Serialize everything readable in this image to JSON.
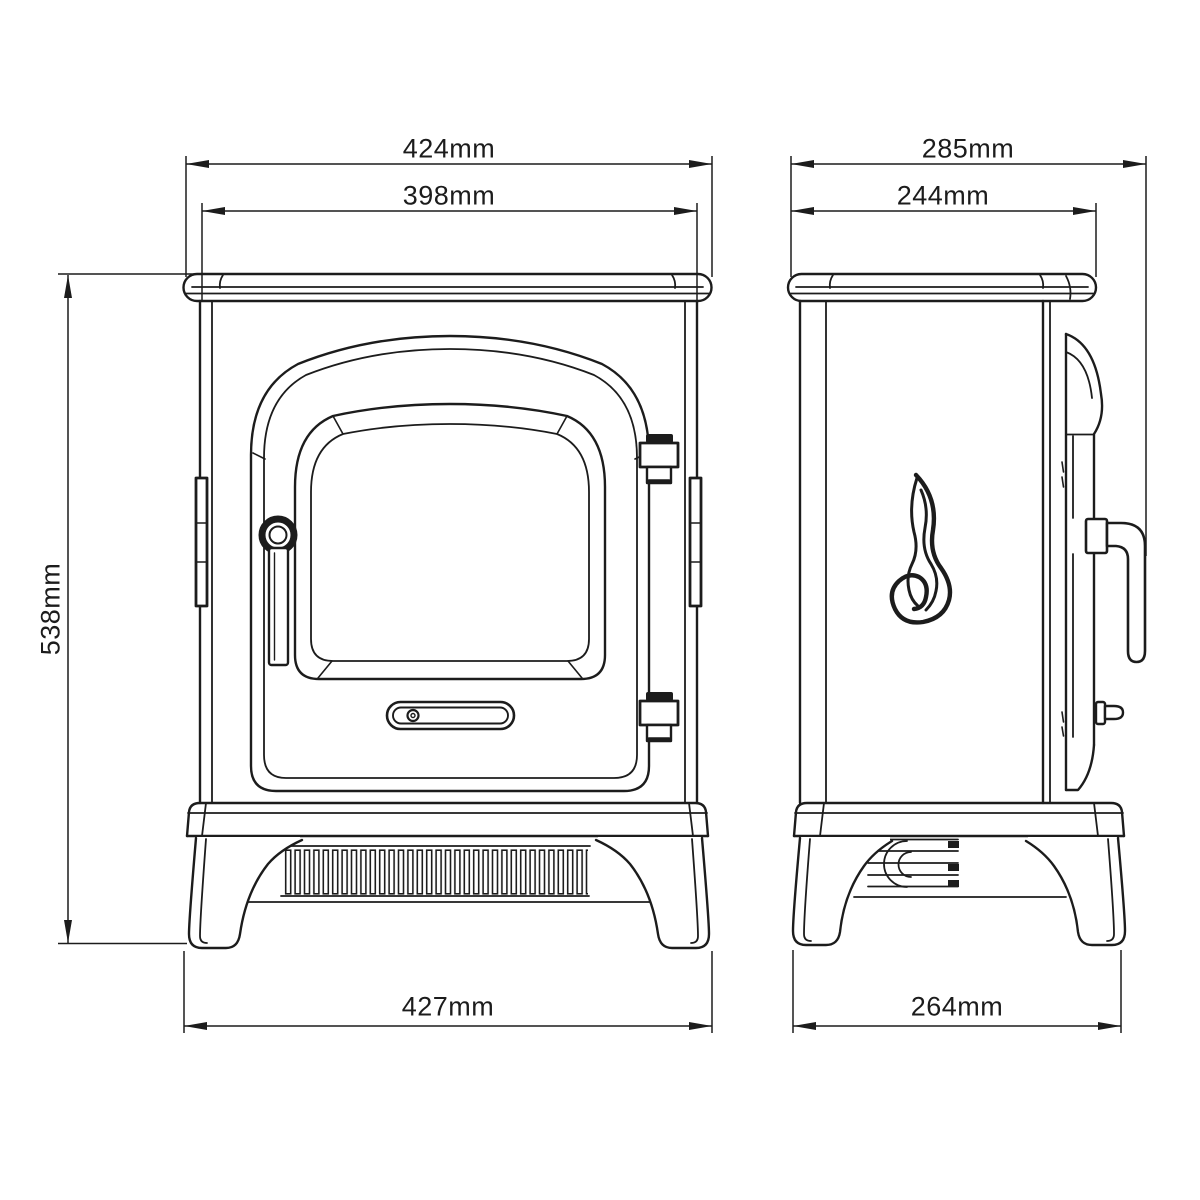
{
  "drawing": {
    "background": "#ffffff",
    "line_color": "#1c1c1c",
    "unit": "mm",
    "front_view": {
      "dim_overall_width": "424mm",
      "dim_body_width": "398mm",
      "dim_overall_height": "538mm",
      "dim_base_width": "427mm"
    },
    "side_view": {
      "dim_overall_depth": "285mm",
      "dim_body_depth": "244mm",
      "dim_base_depth": "264mm"
    }
  }
}
